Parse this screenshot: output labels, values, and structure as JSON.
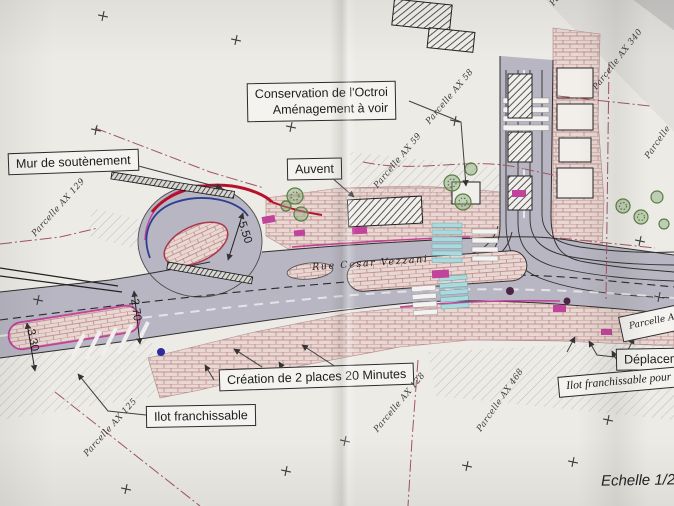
{
  "callouts": {
    "conservation": {
      "line1": "Conservation de l'Octroi",
      "line2": "Aménagement à voir"
    },
    "mur": "Mur de soutènement",
    "auvent": "Auvent",
    "creation": "Création de 2 places 20 Minutes",
    "ilot": "Ilot franchissable",
    "deplacement": "Déplacement",
    "ilot_droite": "Ilot franchissable pour co",
    "parcelle_box": "Parcelle A"
  },
  "parcels": [
    {
      "label": "Parcelle AX 505"
    },
    {
      "label": "Parcelle AX 340"
    },
    {
      "label": "Parcelle AX 58"
    },
    {
      "label": "Parcelle AX 59"
    },
    {
      "label": "Parcelle AX 129"
    },
    {
      "label": "Parcelle AX 125"
    },
    {
      "label": "Parcelle AX 128"
    },
    {
      "label": "Parcelle AX 468"
    },
    {
      "label": "Parcelle"
    }
  ],
  "street": {
    "name": "Rue Cesar Vezzani"
  },
  "dimensions": {
    "w550": "5.50",
    "w270": "2.70",
    "w330": "3.30"
  },
  "scale": {
    "text": "Echelle 1/2"
  },
  "colors": {
    "road": "#b8b6c2",
    "paving": "#e8d8d1",
    "paving_joint": "#b97f86",
    "accent_magenta": "#c2439b",
    "wall_red": "#b5102c",
    "guide_blue": "#2b3f8f",
    "crosswalk_cyan": "#abdade",
    "tree_green": "#55803f",
    "boundary": "#a05468",
    "paper": "#edebe6",
    "ink": "#1c1c1c"
  }
}
